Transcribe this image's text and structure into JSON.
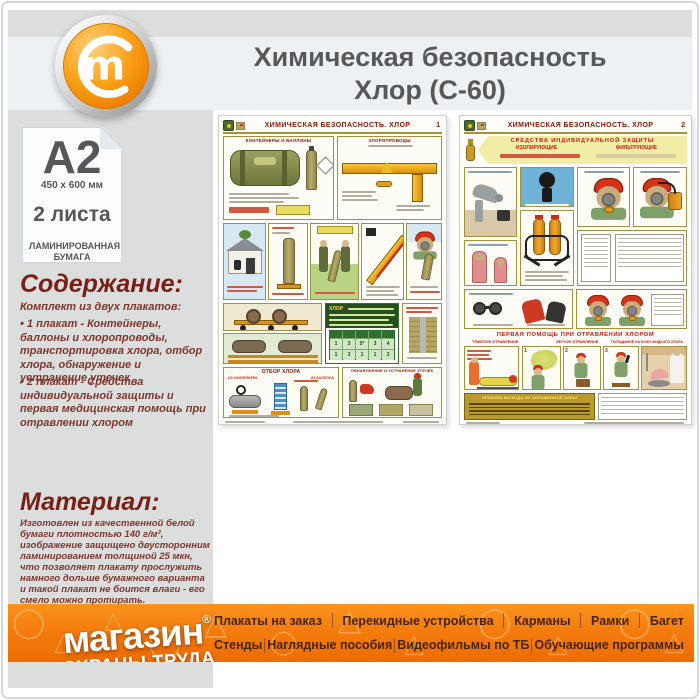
{
  "header": {
    "title_line1": "Химическая безопасность",
    "title_line2": "Хлор (С-60)",
    "logo_letter": "m"
  },
  "sidebar": {
    "paper": {
      "format": "А2",
      "size": "450 x 600 мм",
      "sheets": "2 листа",
      "paper_type": "ЛАМИНИРОВАННАЯ БУМАГА"
    },
    "contents": {
      "heading": "Содержание:",
      "intro": "Комплект из двух плакатов:",
      "item1": "• 1 плакат - Контейнеры, баллоны и хлоропроводы, транспортировка хлора, отбор хлора, обнаружение и устранение утечек",
      "item2": "• 2 плакат - Средства индивидуальной защиты и первая медицинская помощь при отравлении хлором"
    },
    "material": {
      "heading": "Материал:",
      "text": "Изготовлен из качественной белой бумаги плотностью 140 г/м², изображение защищено двусторонним ламинированием толщиной 25 мкн, что позволяет плакату прослужить намного дольше бумажного варианта и такой плакат не боится влаги - его смело можно протирать."
    }
  },
  "posters": {
    "p1": {
      "title": "ХИМИЧЕСКАЯ БЕЗОПАСНОСТЬ. ХЛОР",
      "number": "1",
      "sec_containers": "КОНТЕЙНЕРЫ И БАЛЛОНЫ",
      "sec_pipes": "ХЛОРОПРОВОДЫ",
      "sec_selection": "ОТБОР ХЛОРА",
      "sub_from_container": "ИЗ КОНТЕЙНЕРА",
      "sub_from_cylinder": "ИЗ БАЛЛОНА",
      "sec_leaks": "ОБНАРУЖЕНИЕ И УСТРАНЕНИЕ УТЕЧЕК",
      "chlor_word": "ХЛОР",
      "table_row1": [
        "1",
        "3",
        "5*",
        "3",
        "4"
      ],
      "table_row2": [
        "1",
        "3",
        "1",
        "1",
        "3"
      ]
    },
    "p2": {
      "title": "ХИМИЧЕСКАЯ БЕЗОПАСНОСТЬ. ХЛОР",
      "number": "2",
      "banner_title": "СРЕДСТВА ИНДИВИДУАЛЬНОЙ ЗАЩИТЫ",
      "type_left": "ИЗОЛИРУЮЩИЕ",
      "type_right": "ФИЛЬТРУЮЩИЕ",
      "first_aid": "ПЕРВАЯ ПОМОЩЬ ПРИ ОТРАВЛЕНИИ ХЛОРОМ",
      "severe_label": "ТЯЖЕЛОЕ ОТРАВЛЕНИЕ",
      "light_label": "ЛЕГКОЕ ОТРАВЛЕНИЕ",
      "skin_label": "ПОПАДАНИЕ НА КОЖУ ЖИДКОГО ХЛОРА",
      "exit_rules": "ПРАВИЛА ВЫХОДА ИЗ ЗАРАЖЕННОЙ ЗОНЫ",
      "scene_numbers": [
        "1",
        "2",
        "3"
      ]
    }
  },
  "footer": {
    "brand": {
      "name": "магазин",
      "reg": "®",
      "tagline": "ОХРАНЫ ТРУДА"
    },
    "menu_row1": [
      "Плакаты на заказ",
      "Перекидные устройства",
      "Карманы",
      "Рамки",
      "Багет"
    ],
    "menu_row2": [
      "Стенды",
      "Наглядные пособия",
      "Видеофильмы по ТБ",
      "Обучающие программы"
    ]
  },
  "colors": {
    "footer_orange": "#f47d0e",
    "heading_maroon": "#7a1f17",
    "poster_title_red": "#8c1500",
    "accent_gold": "#a3913f"
  }
}
